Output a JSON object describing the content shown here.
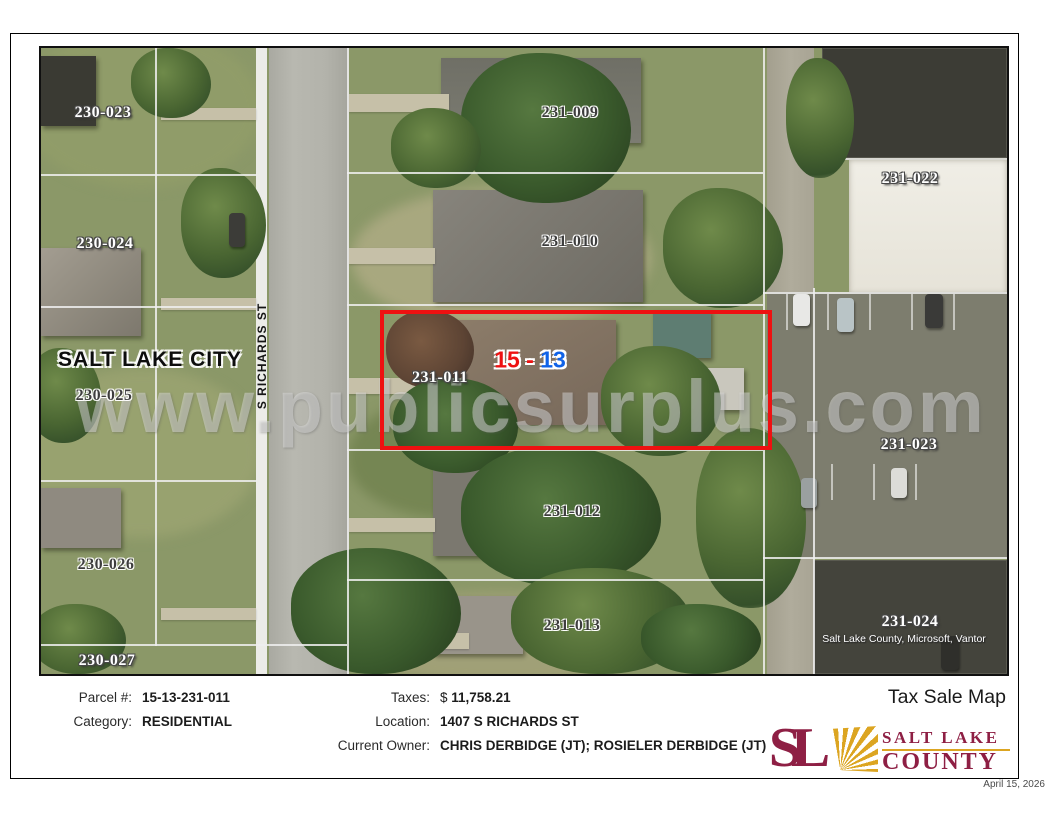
{
  "page": {
    "date": "April 15, 2026"
  },
  "map": {
    "city_label": "SALT LAKE CITY",
    "street_label": "S RICHARDS ST",
    "watermark": "www.publicsurplus.com",
    "attribution": "Salt Lake County, Microsoft, Vantor",
    "highlight_color": "#ee1111",
    "highlight_label": {
      "left": "15 -",
      "right": "13",
      "left_color": "#ee1111",
      "right_color": "#0f62e8"
    },
    "highlighted_parcel": "231-011",
    "parcels": [
      {
        "id": "230-023",
        "x": 62,
        "y": 65,
        "style": "light"
      },
      {
        "id": "230-024",
        "x": 64,
        "y": 196,
        "style": "light"
      },
      {
        "id": "230-025",
        "x": 63,
        "y": 348,
        "style": "dark"
      },
      {
        "id": "230-026",
        "x": 65,
        "y": 517,
        "style": "dark"
      },
      {
        "id": "230-027",
        "x": 66,
        "y": 613,
        "style": "light"
      },
      {
        "id": "231-009",
        "x": 529,
        "y": 65,
        "style": "dark"
      },
      {
        "id": "231-010",
        "x": 529,
        "y": 194,
        "style": "dark"
      },
      {
        "id": "231-011",
        "x": 399,
        "y": 330,
        "style": "light"
      },
      {
        "id": "231-012",
        "x": 531,
        "y": 464,
        "style": "dark"
      },
      {
        "id": "231-013",
        "x": 531,
        "y": 578,
        "style": "dark"
      },
      {
        "id": "231-022",
        "x": 869,
        "y": 131,
        "style": "light"
      },
      {
        "id": "231-023",
        "x": 868,
        "y": 397,
        "style": "light"
      },
      {
        "id": "231-024",
        "x": 869,
        "y": 574,
        "style": "light"
      }
    ]
  },
  "details": {
    "title": "Tax Sale Map",
    "left_rows": [
      {
        "label": "Parcel #:",
        "value": "15-13-231-011"
      },
      {
        "label": "Category:",
        "value": "RESIDENTIAL"
      }
    ],
    "right_rows": [
      {
        "label": "Taxes:",
        "prefix": "$ ",
        "value": "11,758.21"
      },
      {
        "label": "Location:",
        "value": "1407 S RICHARDS ST"
      },
      {
        "label": "Current Owner:",
        "value": "CHRIS DERBIDGE (JT); ROSIELER DERBIDGE (JT)"
      }
    ]
  },
  "logo": {
    "monogram": "SL",
    "line1": "SALT LAKE",
    "line2": "COUNTY",
    "maroon": "#8e1f44",
    "gold": "#dca521"
  }
}
